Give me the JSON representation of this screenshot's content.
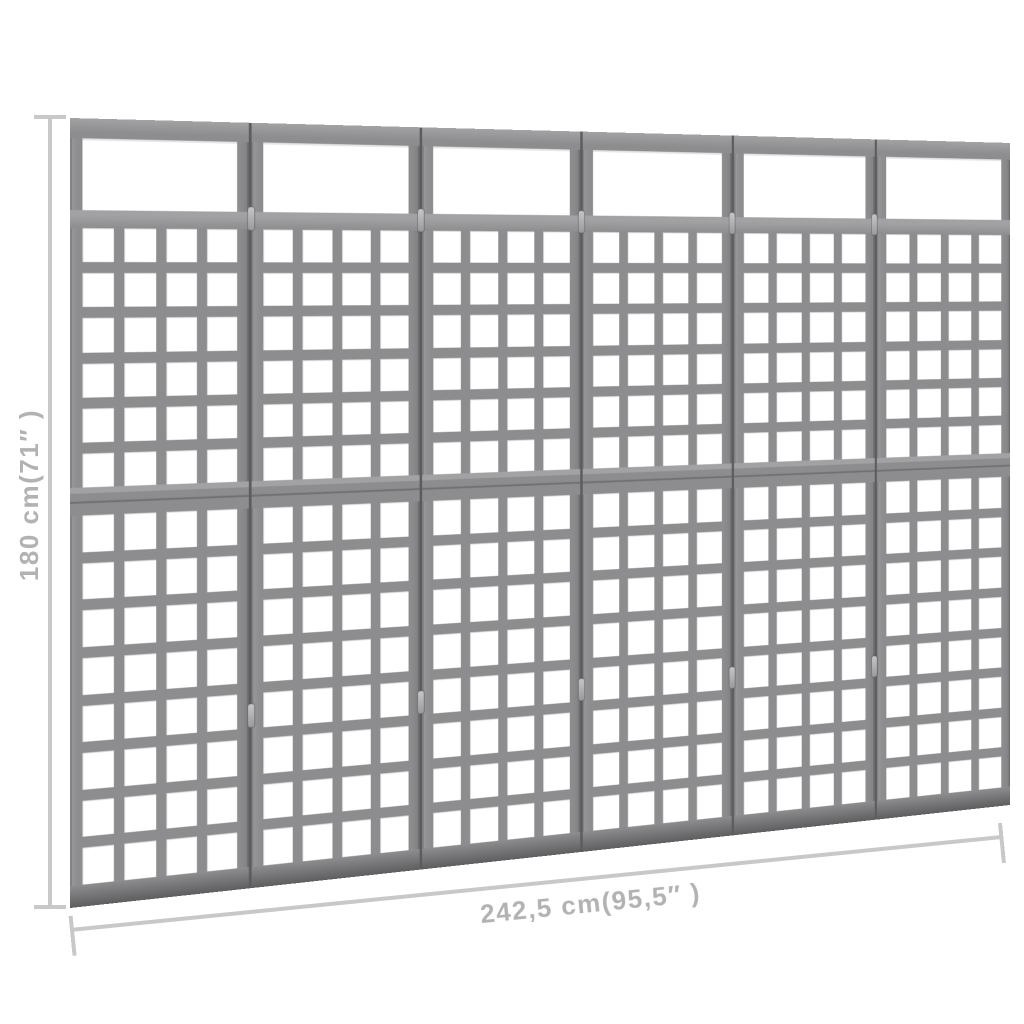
{
  "product": {
    "type": "room-divider-trellis",
    "panel_count": 6,
    "panel_sections": {
      "open_top": true,
      "upper_lattice": {
        "rows": 6,
        "cols": 4
      },
      "lower_lattice": {
        "rows": 8,
        "cols": 4
      }
    },
    "hinges_per_junction": 2,
    "colors": {
      "wood": "#8d8d8f",
      "woodlight": "#a2a2a4",
      "woodshadow": "#717173",
      "seam": "#5c5c5e"
    }
  },
  "dimensions": {
    "height": {
      "label": "180 cm(71″ )",
      "value_cm": "180",
      "value_inch": "71"
    },
    "width": {
      "label": "242,5 cm(95,5″ )",
      "value_cm": "242,5",
      "value_inch": "95,5"
    },
    "line_color": "#c8c8c8",
    "text_color": "#b2b2b2"
  }
}
